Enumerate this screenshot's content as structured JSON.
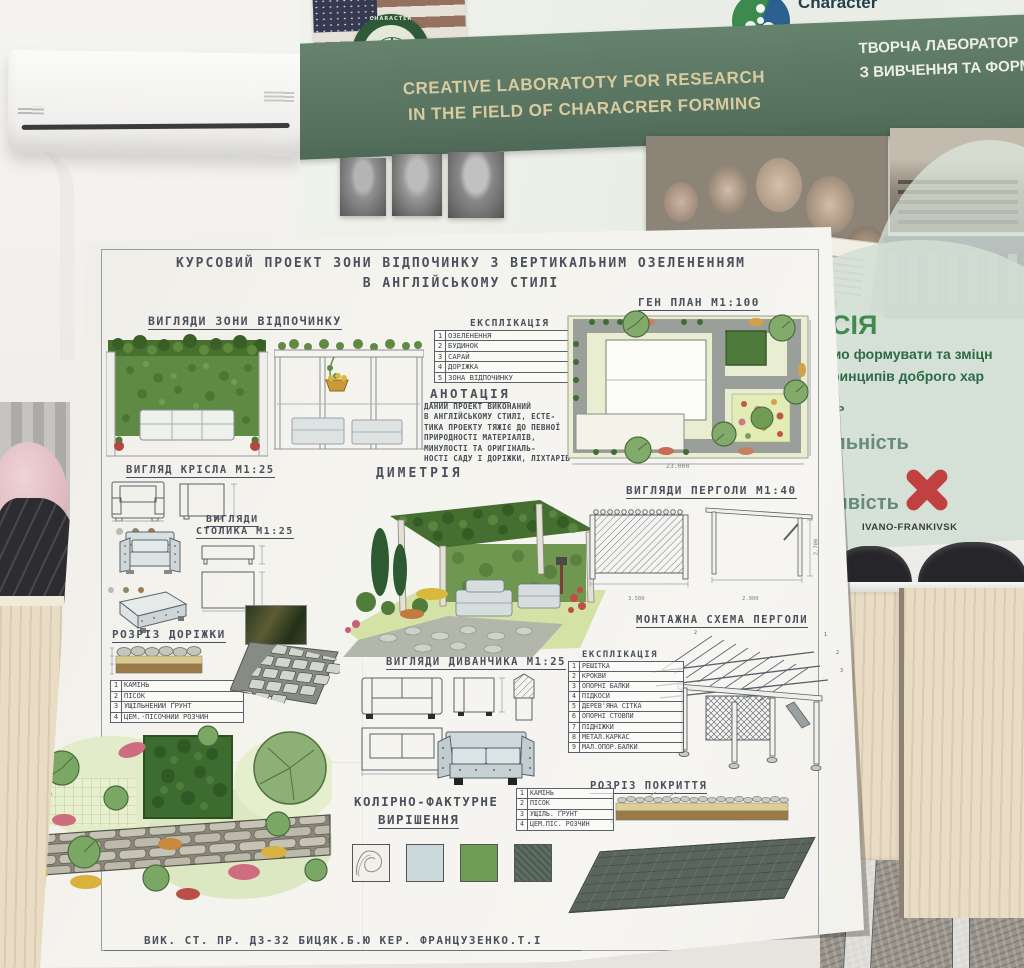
{
  "banner": {
    "seal_text": "CHARACTER",
    "logo_title": "Character",
    "logo_subtitle": "for Kids",
    "en_line1": "CREATIVE LABORATOTY FOR RESEARCH",
    "en_line2": "IN THE FIELD OF CHARACRER FORMING",
    "ua_line1": "ТВОРЧА ЛАБОРАТОР",
    "ua_line2": "З ВИВЧЕННЯ ТА ФОРМУВАННЯ",
    "mission_heading": "СІЯ",
    "mission_line1": "мо формувати та зміцн",
    "mission_line2": "ринципів доброго хар",
    "fragment1": "ь",
    "fragment2": "льність",
    "fragment3": "мвість",
    "city": "IVANO-FRANKIVSK"
  },
  "poster": {
    "title_line1": "КУРСОВИЙ ПРОЕКТ ЗОНИ ВІДПОЧИНКУ З ВЕРТИКАЛЬНИМ ОЗЕЛЕНЕННЯМ",
    "title_line2": "В АНГЛІЙСЬКОМУ СТИЛІ",
    "views_zone": "ВИГЛЯДИ ЗОНИ ВІДПОЧИНКУ",
    "genplan": "ГЕН ПЛАН М1:100",
    "genplan_dim": "23.000",
    "explication1": {
      "title": "ЕКСПЛІКАЦІЯ",
      "rows": [
        {
          "n": "1",
          "label": "ОЗЕЛЕНЕННЯ"
        },
        {
          "n": "2",
          "label": "БУДИНОК"
        },
        {
          "n": "3",
          "label": "САРАЙ"
        },
        {
          "n": "4",
          "label": "ДОРІЖКА"
        },
        {
          "n": "5",
          "label": "ЗОНА ВІДПОЧИНКУ"
        }
      ]
    },
    "annotation": {
      "title": "АНОТАЦІЯ",
      "lines": [
        "ДАНИЙ ПРОЕКТ ВИКОНАНИЙ",
        "В АНГЛІЙСЬКОМУ СТИЛІ, ЕСТЕ-",
        "ТИКА ПРОЕКТУ ТЯЖІЄ ДО ПЕВНОЇ",
        "ПРИРОДНОСТІ МАТЕРІАЛІВ,",
        "МИНУЛОСТІ ТА ОРИГІНАЛЬ-",
        "НОСТІ САДУ І ДОРІЖКИ, ЛІХТАРІВ"
      ]
    },
    "chair": "ВИГЛЯД КРІСЛА М1:25",
    "table_views_1": "ВИГЛЯДИ",
    "table_views_2": "СТОЛИКА М1:25",
    "dimetry": "ДИМЕТРІЯ",
    "pergola_views": "ВИГЛЯДИ ПЕРГОЛИ М1:40",
    "pergola_dims": {
      "d1": "3.500",
      "d2": "2.900",
      "d3": "2.700"
    },
    "path_section": {
      "title": "РОЗРІЗ ДОРІЖКИ",
      "rows": [
        {
          "n": "1",
          "label": "КАМІНЬ"
        },
        {
          "n": "2",
          "label": "ПІСОК"
        },
        {
          "n": "3",
          "label": "УЩІЛЬНЕНИЙ ҐРУНТ"
        },
        {
          "n": "4",
          "label": "ЦЕМ.-ПІСОЧНИЙ РОЗЧИН"
        }
      ]
    },
    "sofa_views": "ВИГЛЯДИ ДИВАНЧИКА М1:25",
    "montage": "МОНТАЖНА СХЕМА ПЕРГОЛИ",
    "explication2": {
      "title": "ЕКСПЛІКАЦІЯ",
      "rows": [
        {
          "n": "1",
          "label": "РЕШІТКА"
        },
        {
          "n": "2",
          "label": "КРОКВИ"
        },
        {
          "n": "3",
          "label": "ОПОРНІ БАЛКИ"
        },
        {
          "n": "4",
          "label": "ПІДКОСИ"
        },
        {
          "n": "5",
          "label": "ДЕРЕВ'ЯНА СІТКА"
        },
        {
          "n": "6",
          "label": "ОПОРНІ СТОВПИ"
        },
        {
          "n": "7",
          "label": "ПІДНІЖКИ"
        },
        {
          "n": "8",
          "label": "МЕТАЛ.КАРКАС"
        },
        {
          "n": "9",
          "label": "МАЛ.ОПОР.БАЛКИ"
        }
      ]
    },
    "coating_section": {
      "title": "РОЗРІЗ ПОКРИТТЯ",
      "rows": [
        {
          "n": "1",
          "label": "КАМІНЬ"
        },
        {
          "n": "2",
          "label": "ПІСОК"
        },
        {
          "n": "3",
          "label": "УЩІЛЬ. ҐРУНТ"
        },
        {
          "n": "4",
          "label": "ЦЕМ.ПІС. РОЗЧИН"
        }
      ]
    },
    "color_solution_1": "КОЛІРНО-ФАКТУРНЕ",
    "color_solution_2": "ВИРІШЕННЯ",
    "credit": "ВИК. СТ. ПР. Д3-32 БИЦЯК.Б.Ю  КЕР. ФРАНЦУЗЕНКО.Т.І"
  },
  "colors": {
    "banner_green": "#5e7b66",
    "accent_red": "#c14040",
    "leaf_green": "#5e8a44",
    "swatch_wood": "#f2f0e8",
    "swatch_blue": "#ccd9dc",
    "swatch_green": "#6f9c55",
    "swatch_dark": "#5c6e62"
  }
}
